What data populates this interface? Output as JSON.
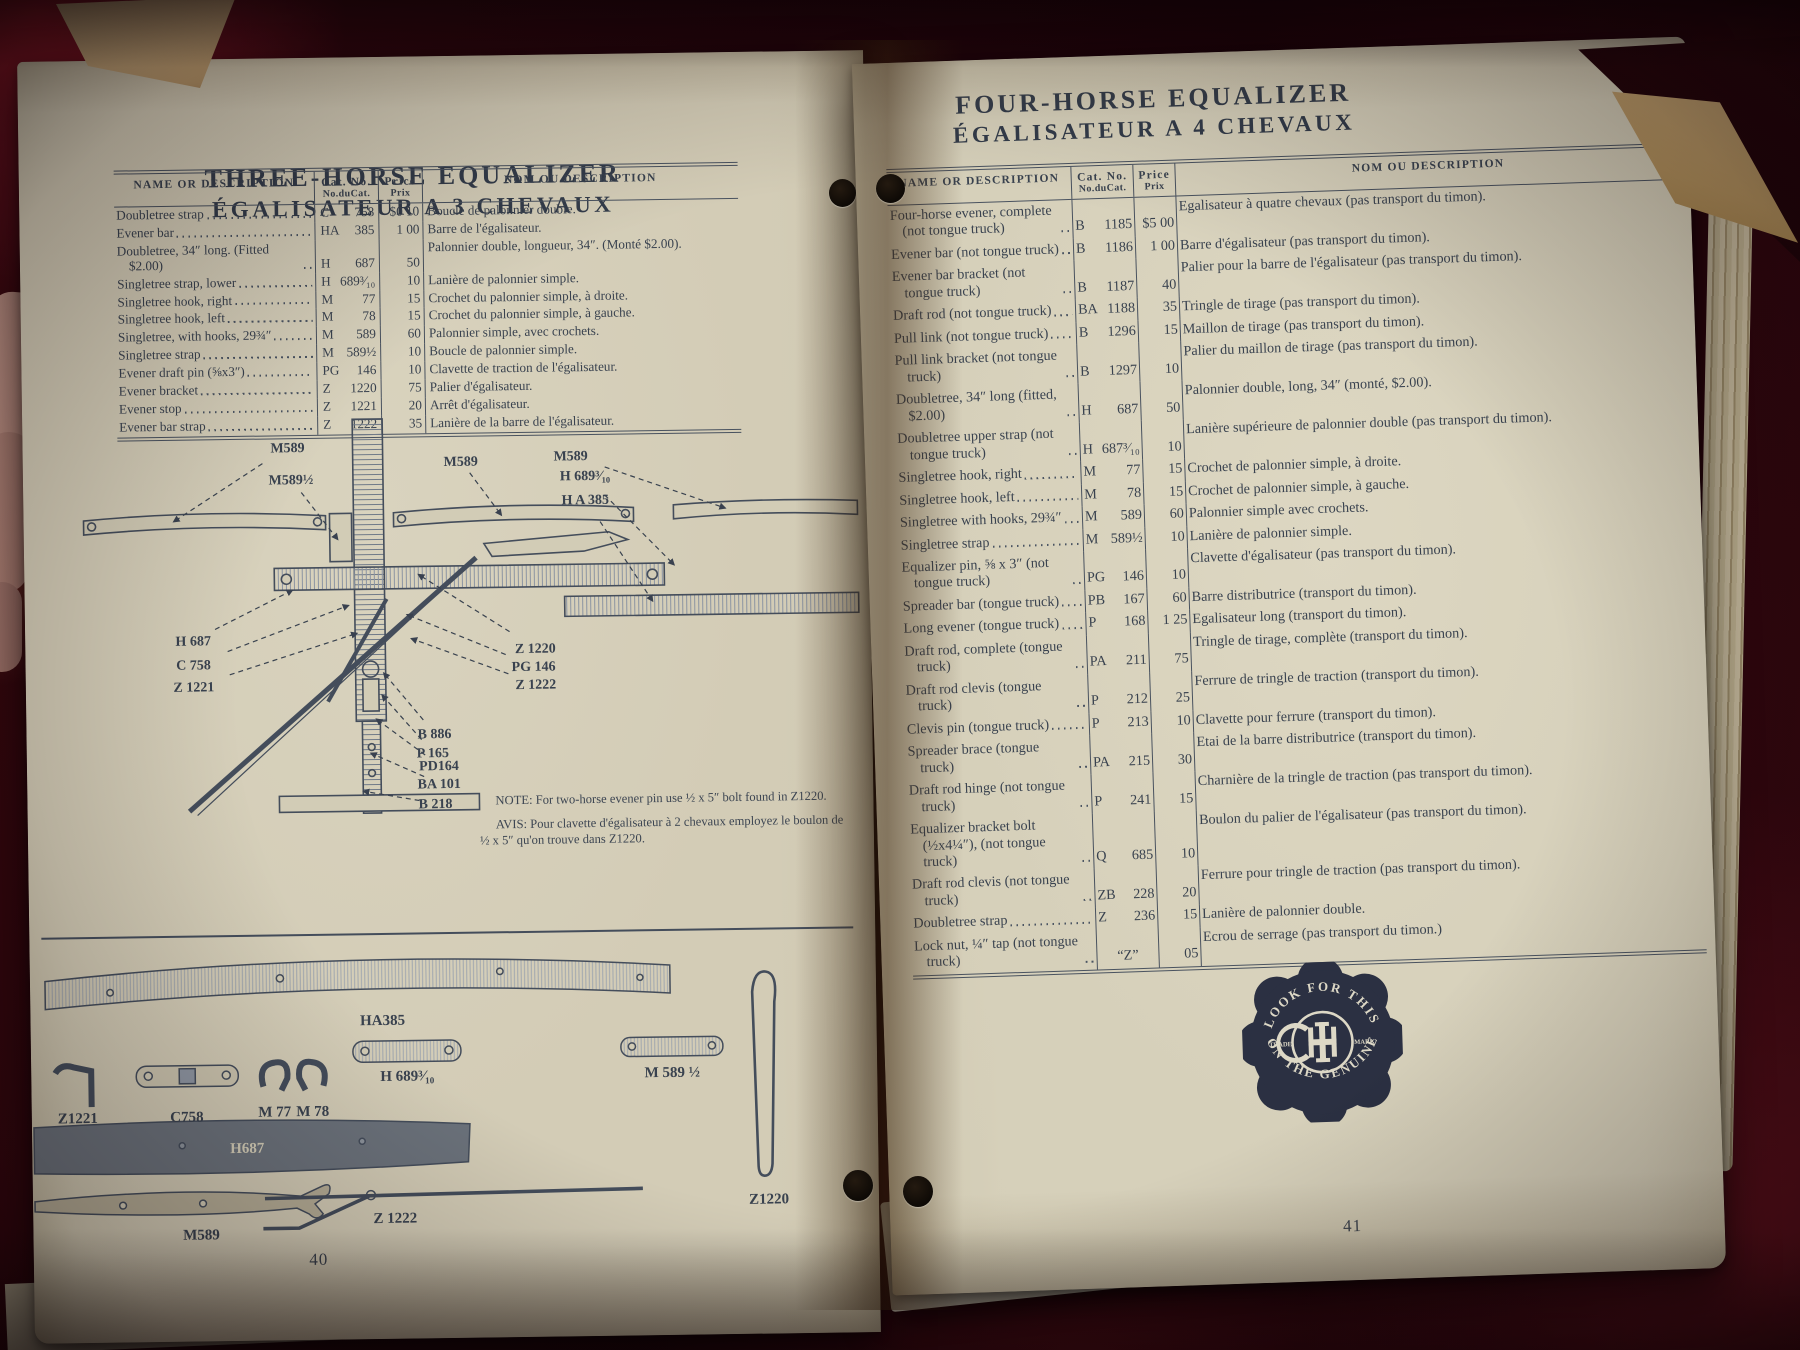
{
  "table_headers": {
    "name": "NAME OR DESCRIPTION",
    "cat1": "Cat. No.",
    "cat2": "No.duCat.",
    "price1": "Price",
    "price2": "Prix",
    "nom": "NOM OU DESCRIPTION"
  },
  "left_page": {
    "title_en": "THREE-HORSE EQUALIZER",
    "title_fr": "ÉGALISATEUR A 3 CHEVAUX",
    "page_number": "40",
    "table": {
      "rows": [
        {
          "name": "Doubletree strap",
          "cat": "C 758",
          "price": "$0 10",
          "nom": "Boucle de palonnier double."
        },
        {
          "name": "Evener bar",
          "cat": "HA 385",
          "price": "1 00",
          "nom": "Barre de l'égalisateur."
        },
        {
          "name": "Doubletree, 34″ long. (Fitted $2.00)",
          "cat": "H 687",
          "price": "50",
          "nom": "Palonnier double, longueur, 34″. (Monté $2.00)."
        },
        {
          "name": "Singletree strap, lower",
          "cat": "H 689³⁄₁₀",
          "price": "10",
          "nom": "Lanière de palonnier simple."
        },
        {
          "name": "Singletree hook, right",
          "cat": "M 77",
          "price": "15",
          "nom": "Crochet du palonnier simple, à droite."
        },
        {
          "name": "Singletree hook, left",
          "cat": "M 78",
          "price": "15",
          "nom": "Crochet du palonnier simple, à gauche."
        },
        {
          "name": "Singletree, with hooks, 29¾″",
          "cat": "M 589",
          "price": "60",
          "nom": "Palonnier simple, avec crochets."
        },
        {
          "name": "Singletree strap",
          "cat": "M 589½",
          "price": "10",
          "nom": "Boucle de palonnier simple."
        },
        {
          "name": "Evener draft pin (⅝x3″)",
          "cat": "PG 146",
          "price": "10",
          "nom": "Clavette de traction de l'égalisateur."
        },
        {
          "name": "Evener bracket",
          "cat": "Z 1220",
          "price": "75",
          "nom": "Palier d'égalisateur."
        },
        {
          "name": "Evener stop",
          "cat": "Z 1221",
          "price": "20",
          "nom": "Arrêt d'égalisateur."
        },
        {
          "name": "Evener bar strap",
          "cat": "Z 1222",
          "price": "35",
          "nom": "Lanière de la barre de l'égalisateur."
        }
      ]
    },
    "diagram_labels": [
      {
        "t": "M589",
        "x": 265,
        "y": 34,
        "tx": 150,
        "ty": 102
      },
      {
        "t": "M589½",
        "x": 268,
        "y": 66,
        "tx": 314,
        "ty": 122
      },
      {
        "t": "M589",
        "x": 438,
        "y": 50,
        "tx": 478,
        "ty": 100
      },
      {
        "t": "M589",
        "x": 548,
        "y": 46,
        "tx": 702,
        "ty": 96
      },
      {
        "t": "H 689³⁄₁₀",
        "x": 562,
        "y": 66,
        "tx": 650,
        "ty": 152
      },
      {
        "t": "H A 385",
        "x": 562,
        "y": 90,
        "tx": 628,
        "ty": 188
      },
      {
        "t": "H 687",
        "x": 168,
        "y": 226,
        "tx": 268,
        "ty": 172
      },
      {
        "t": "C 758",
        "x": 168,
        "y": 250,
        "tx": 324,
        "ty": 188
      },
      {
        "t": "Z 1221",
        "x": 168,
        "y": 272,
        "tx": 332,
        "ty": 216
      },
      {
        "t": "Z 1220",
        "x": 510,
        "y": 238,
        "tx": 394,
        "ty": 158
      },
      {
        "t": "PG 146",
        "x": 508,
        "y": 256,
        "tx": 382,
        "ty": 198
      },
      {
        "t": "Z 1222",
        "x": 510,
        "y": 274,
        "tx": 386,
        "ty": 222
      },
      {
        "t": "B 886",
        "x": 408,
        "y": 322,
        "tx": 358,
        "ty": 256
      },
      {
        "t": "P 165",
        "x": 406,
        "y": 341,
        "tx": 356,
        "ty": 278
      },
      {
        "t": "PD164",
        "x": 412,
        "y": 354,
        "tx": 350,
        "ty": 302
      },
      {
        "t": "BA 101",
        "x": 412,
        "y": 372,
        "tx": 344,
        "ty": 336
      },
      {
        "t": "B 218",
        "x": 408,
        "y": 392,
        "tx": 336,
        "ty": 374
      }
    ],
    "note_en": "NOTE:  For two-horse evener pin use ½ x 5″ bolt found in Z1220.",
    "note_fr": "AVIS:  Pour clavette d'égalisateur à 2 chevaux employez le boulon de ½ x 5″ qu'on trouve dans Z1220.",
    "parts_labels": {
      "ha385": "HA385",
      "z1221": "Z1221",
      "c758": "C758",
      "m77": "M 77",
      "m78": "M 78",
      "h689": "H 689³⁄₁₀",
      "m589h": "M 589 ½",
      "h687": "H687",
      "m589": "M589",
      "z1222": "Z 1222",
      "z1220": "Z1220"
    }
  },
  "right_page": {
    "title_en": "FOUR-HORSE EQUALIZER",
    "title_fr": "ÉGALISATEUR A 4 CHEVAUX",
    "page_number": "41",
    "table": {
      "rows": [
        {
          "name": "Four-horse evener, complete (not tongue truck)",
          "cat": "B 1185",
          "price": "$5 00",
          "nom": "Egalisateur à quatre chevaux (pas transport du timon)."
        },
        {
          "name": "Evener bar (not tongue truck)",
          "cat": "B 1186",
          "price": "1 00",
          "nom": "Barre d'égalisateur (pas transport du timon)."
        },
        {
          "name": "Evener bar bracket (not tongue truck)",
          "cat": "B 1187",
          "price": "40",
          "nom": "Palier pour la barre de l'égalisateur (pas transport du timon)."
        },
        {
          "name": "Draft rod (not tongue truck)",
          "cat": "BA 1188",
          "price": "35",
          "nom": "Tringle de tirage (pas transport du timon)."
        },
        {
          "name": "Pull link (not tongue truck)",
          "cat": "B 1296",
          "price": "15",
          "nom": "Maillon de tirage (pas transport du timon)."
        },
        {
          "name": "Pull link bracket (not tongue truck)",
          "cat": "B 1297",
          "price": "10",
          "nom": "Palier du maillon de tirage (pas transport du timon)."
        },
        {
          "name": "Doubletree, 34″ long (fitted, $2.00)",
          "cat": "H 687",
          "price": "50",
          "nom": "Palonnier double, long, 34″ (monté, $2.00)."
        },
        {
          "name": "Doubletree upper strap (not tongue truck)",
          "cat": "H 687³⁄₁₀",
          "price": "10",
          "nom": "Lanière supérieure de palonnier double (pas transport du timon)."
        },
        {
          "name": "Singletree hook, right",
          "cat": "M 77",
          "price": "15",
          "nom": "Crochet de palonnier simple, à droite."
        },
        {
          "name": "Singletree hook, left",
          "cat": "M 78",
          "price": "15",
          "nom": "Crochet de palonnier simple, à gauche."
        },
        {
          "name": "Singletree with hooks, 29¾″",
          "cat": "M 589",
          "price": "60",
          "nom": "Palonnier simple avec crochets."
        },
        {
          "name": "Singletree strap",
          "cat": "M 589½",
          "price": "10",
          "nom": "Lanière de palonnier simple."
        },
        {
          "name": "Equalizer pin, ⅝ x 3″ (not tongue truck)",
          "cat": "PG 146",
          "price": "10",
          "nom": "Clavette d'égalisateur (pas transport du timon)."
        },
        {
          "name": "Spreader bar (tongue truck)",
          "cat": "PB 167",
          "price": "60",
          "nom": "Barre distributrice (transport du timon)."
        },
        {
          "name": "Long evener (tongue truck)",
          "cat": "P 168",
          "price": "1 25",
          "nom": "Egalisateur long (transport du timon)."
        },
        {
          "name": "Draft rod, complete (tongue truck)",
          "cat": "PA 211",
          "price": "75",
          "nom": "Tringle de tirage, complète (transport du timon)."
        },
        {
          "name": "Draft rod clevis (tongue truck)",
          "cat": "P 212",
          "price": "25",
          "nom": "Ferrure de tringle de traction (transport du timon)."
        },
        {
          "name": "Clevis pin (tongue truck)",
          "cat": "P 213",
          "price": "10",
          "nom": "Clavette pour ferrure (transport du timon)."
        },
        {
          "name": "Spreader brace (tongue truck)",
          "cat": "PA 215",
          "price": "30",
          "nom": "Etai de la barre distributrice (transport du timon)."
        },
        {
          "name": "Draft rod hinge (not tongue truck)",
          "cat": "P 241",
          "price": "15",
          "nom": "Charnière de la tringle de traction (pas transport du timon)."
        },
        {
          "name": "Equalizer bracket bolt (½x4¼″), (not tongue truck)",
          "cat": "Q 685",
          "price": "10",
          "nom": "Boulon du palier de l'égalisateur (pas transport du timon)."
        },
        {
          "name": "Draft rod clevis (not tongue truck)",
          "cat": "ZB 228",
          "price": "20",
          "nom": "Ferrure pour tringle de traction (pas transport du timon)."
        },
        {
          "name": "Doubletree strap",
          "cat": "Z 236",
          "price": "15",
          "nom": "Lanière de palonnier double."
        },
        {
          "name": "Lock nut, ¼″ tap (not tongue truck)",
          "cat": "“Z”",
          "price": "05",
          "nom": "Ecrou de serrage (pas transport du timon.)"
        }
      ]
    },
    "trademark": {
      "top": "LOOK FOR THIS",
      "bottom": "ON THE GENUINE",
      "left": "TRADE",
      "right": "MARK",
      "monogram": "IHC"
    }
  }
}
